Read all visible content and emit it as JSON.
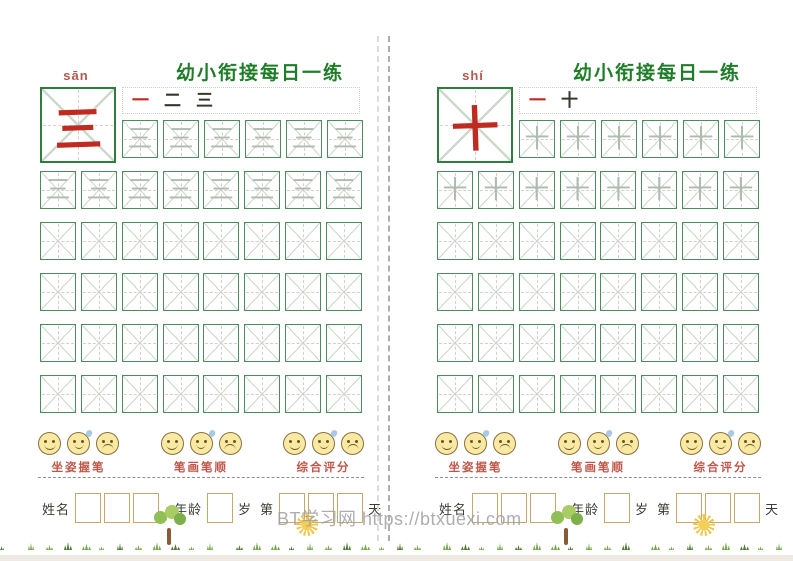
{
  "watermark": "BT学习网 https://btxuexi.com",
  "rating_faces": [
    "smile",
    "sweat",
    "frown"
  ],
  "colors": {
    "title_green": "#1f7d2a",
    "char_red": "#bf2b20",
    "pinyin_red": "#b05a50",
    "rating_red": "#c05548",
    "grid_green": "#4d8a5e",
    "bigbox_green": "#2e7d3c",
    "tan": "#c9a76a",
    "ink": "#3c3c34",
    "wm_gray": "#a0a0a0"
  },
  "pages": [
    {
      "title": "幼小衔接每日一练",
      "pinyin": "sān",
      "character": "三",
      "stroke_order": [
        "一",
        "二",
        "三"
      ],
      "practice_rows": [
        {
          "cells": 6,
          "trace": "三"
        },
        {
          "cells": 8,
          "trace": "三"
        },
        {
          "cells": 8,
          "trace": ""
        },
        {
          "cells": 8,
          "trace": ""
        },
        {
          "cells": 8,
          "trace": ""
        },
        {
          "cells": 8,
          "trace": ""
        }
      ],
      "ratings": [
        {
          "label": "坐姿握笔"
        },
        {
          "label": "笔画笔顺"
        },
        {
          "label": "综合评分"
        }
      ],
      "footer": {
        "name_label": "姓名",
        "age_label": "年龄",
        "age_unit": "岁",
        "day_prefix": "第",
        "day_suffix": "天",
        "name_boxes": 3,
        "age_boxes": 1,
        "day_boxes": 3
      }
    },
    {
      "title": "幼小衔接每日一练",
      "pinyin": "shí",
      "character": "十",
      "stroke_order": [
        "一",
        "十"
      ],
      "practice_rows": [
        {
          "cells": 6,
          "trace": "十"
        },
        {
          "cells": 8,
          "trace": "十"
        },
        {
          "cells": 8,
          "trace": ""
        },
        {
          "cells": 8,
          "trace": ""
        },
        {
          "cells": 8,
          "trace": ""
        },
        {
          "cells": 8,
          "trace": ""
        }
      ],
      "ratings": [
        {
          "label": "坐姿握笔"
        },
        {
          "label": "笔画笔顺"
        },
        {
          "label": "综合评分"
        }
      ],
      "footer": {
        "name_label": "姓名",
        "age_label": "年龄",
        "age_unit": "岁",
        "day_prefix": "第",
        "day_suffix": "天",
        "name_boxes": 3,
        "age_boxes": 1,
        "day_boxes": 3
      }
    }
  ]
}
